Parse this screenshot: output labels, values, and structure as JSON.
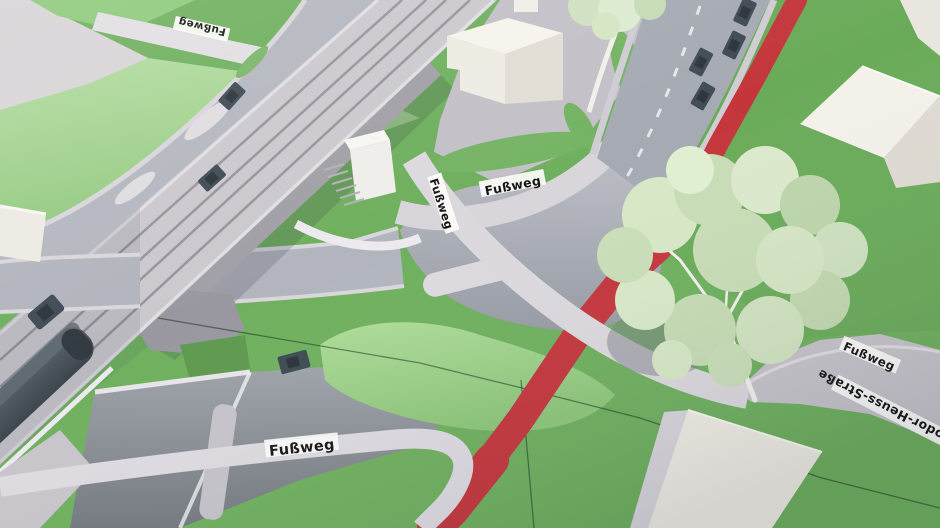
{
  "scene": {
    "kind": "photograph of an architectural traffic-planning scale model",
    "description": "Aerial view of a cardboard urban model: elevated railway with a grey train crossing a road junction, looping access roads, pedestrian paths labelled with tape, a red marked route, one large model tree and white block buildings",
    "board_material": "green painted panels with visible seams"
  },
  "labels": {
    "footpath_top_left": "Fußweg",
    "footpath_bridge_ramp": "Fußweg",
    "footpath_station": "Fußweg",
    "footpath_right": "Fußweg",
    "street_right": "Theodor-Heuss-Straße",
    "footpath_bottom": "Fußweg"
  },
  "colors": {
    "grass": "#6fb05e",
    "embankment_grass": "#a3d391",
    "mound_grass": "#9ed289",
    "road": "#aeb2ba",
    "sunken_road": "#7f858c",
    "footpath": "#dedbe1",
    "railway_deck": "#c8c6cb",
    "route_marking_red": "#c4363c",
    "train": "#4e575f",
    "car": "#3f4a54",
    "building": "#efece2",
    "tree_foliage": "#cfe2c0"
  },
  "counts": {
    "fussweg_label_tapes": 5,
    "street_name_tapes": 1,
    "cars": 8,
    "trains": 1,
    "large_trees": 1,
    "partial_trees_at_edge": 1,
    "buildings": 4
  }
}
